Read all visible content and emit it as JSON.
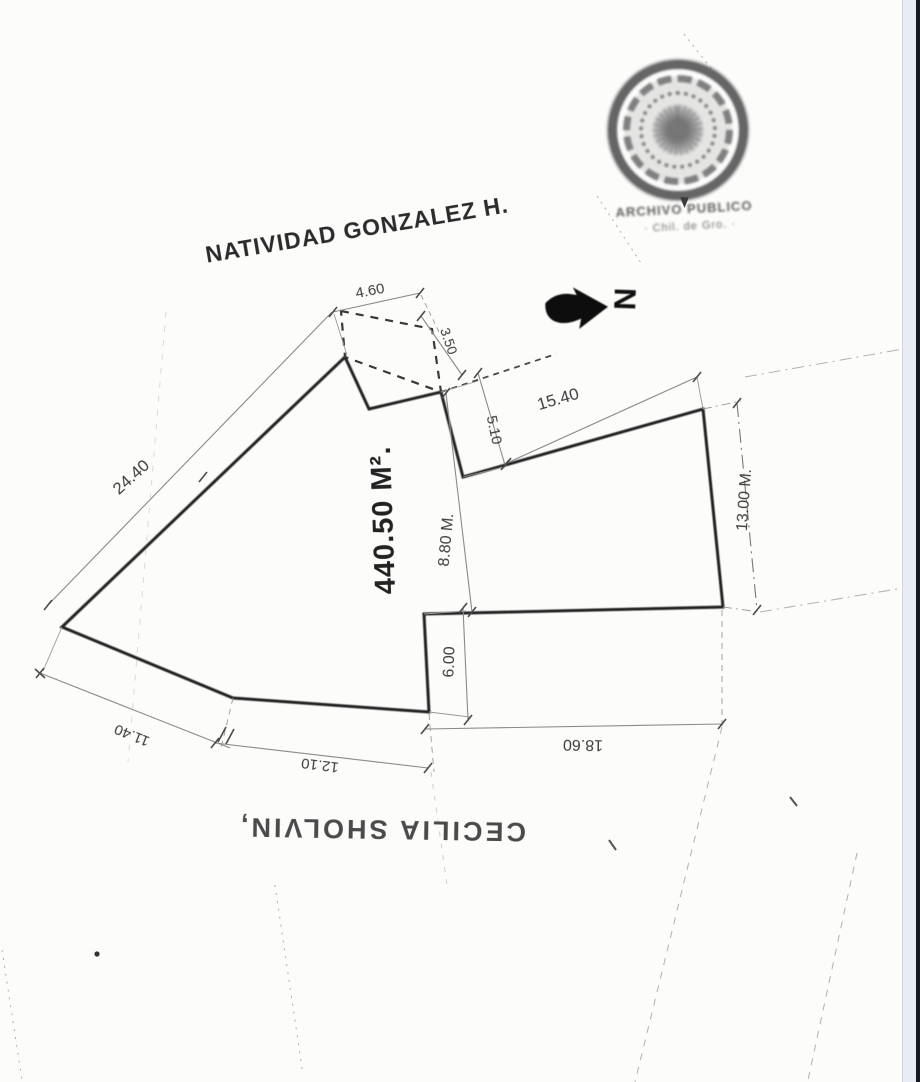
{
  "page": {
    "kind": "scanned cadastral survey plan",
    "paper_color": "#fcfcfb",
    "edge_band_color": "#eaecf3",
    "edge_line_color": "#171922",
    "ink_color": "#222222"
  },
  "plan": {
    "neighbor_north": "NATIVIDAD GONZALEZ H.",
    "neighbor_south": "CECILIA SHOLVIN,",
    "area_label": "440.50 M².",
    "north_letter": "N",
    "dimensions": {
      "top_offset": "4.60",
      "top_offset_side": "3.50",
      "step_depth": "5.10",
      "northeast_edge": "15.40",
      "northwest_edge": "24.40",
      "mid_height": "8.80 M.",
      "east_edge": "13.00 M.",
      "step_height": "6.00",
      "south_east_edge": "18.60",
      "south_mid_edge": "12.10",
      "south_west_edge": "11.40"
    },
    "seal": {
      "caption_line1": "ARCHIVO PUBLICO",
      "caption_line2": "· Chil. de Gro. ·"
    }
  }
}
